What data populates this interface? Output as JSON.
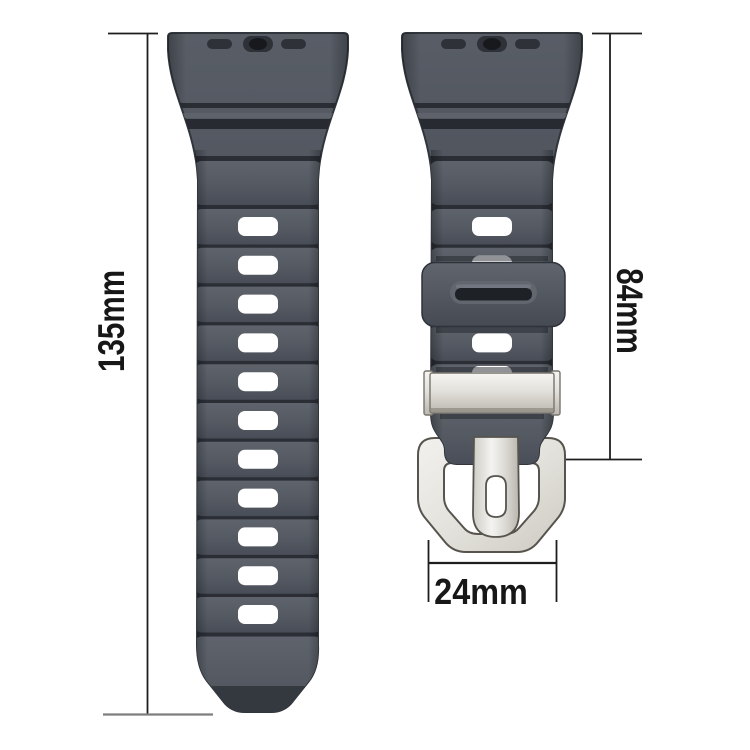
{
  "measurements": {
    "left_strap_length": "135mm",
    "right_strap_length": "84mm",
    "strap_width": "24mm"
  },
  "colors": {
    "background": "#ffffff",
    "strap": "#545962",
    "strap_gap": "#2b2e35",
    "strap_outline": "#31353c",
    "hole": "#ffffff",
    "metal": "#dcdad4",
    "metal_light": "#f2f1ee",
    "metal_shadow": "#b7b4ac",
    "metal_outline": "#57544d",
    "dimension_line": "#1e1e1e",
    "extension_line_gray": "#7e7e7e",
    "label_text": "#171717"
  }
}
